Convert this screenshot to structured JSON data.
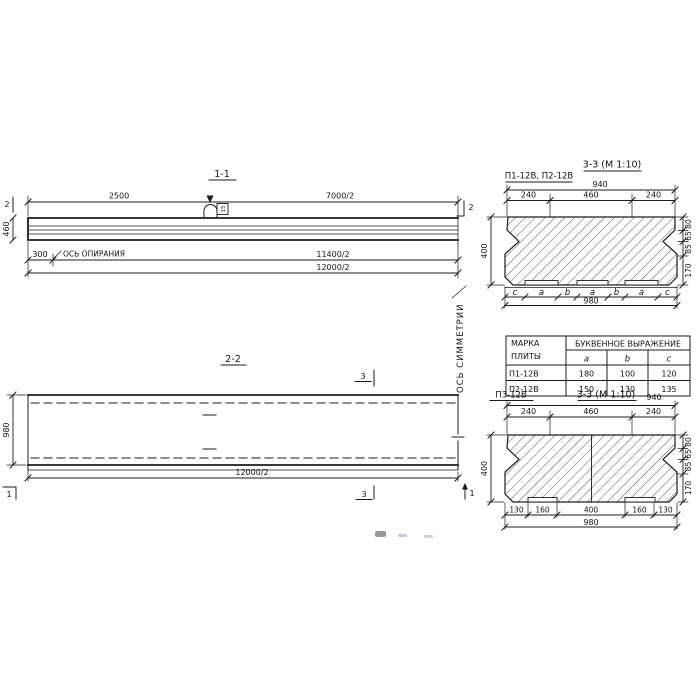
{
  "drawing": {
    "s11": {
      "title": "1-1",
      "d2500": "2500",
      "d7000": "7000/2",
      "d11400": "11400/2",
      "d12000": "12000/2",
      "d300": "300",
      "dh": "460",
      "support": "ОСЬ ОПИРАНИЯ",
      "mark2": "2",
      "hook": "15"
    },
    "s22": {
      "title": "2-2",
      "dh": "980",
      "d12000": "12000/2",
      "mark3": "3",
      "mark1": "1"
    },
    "sym": "ОСЬ СИММЕТРИИ",
    "st": {
      "title": "3-3 (М 1:10)",
      "subtitle": "П1-12В, П2-12В",
      "d940": "940",
      "top": [
        "240",
        "460",
        "240"
      ],
      "right": [
        "80",
        "65",
        "85",
        "170"
      ],
      "letters": [
        "c",
        "a",
        "b",
        "a",
        "b",
        "a",
        "c"
      ],
      "d980": "980",
      "d400": "400"
    },
    "table": {
      "h1a": "МАРКА",
      "h1b": "ПЛИТЫ",
      "h2": "БУКВЕННОЕ  ВЫРАЖЕНИЕ",
      "cols": [
        "a",
        "b",
        "c"
      ],
      "rows": [
        [
          "П1-12В",
          "180",
          "100",
          "120"
        ],
        [
          "П2-12В",
          "150",
          "130",
          "135"
        ]
      ]
    },
    "sb": {
      "name": "П3-12В",
      "title": "3-3 (М 1:10)",
      "d940": "940",
      "top": [
        "240",
        "460",
        "240"
      ],
      "right": [
        "80",
        "65",
        "85",
        "170"
      ],
      "bottom": [
        "130",
        "160",
        "400",
        "160",
        "130"
      ],
      "d980": "980",
      "d400": "400"
    }
  }
}
